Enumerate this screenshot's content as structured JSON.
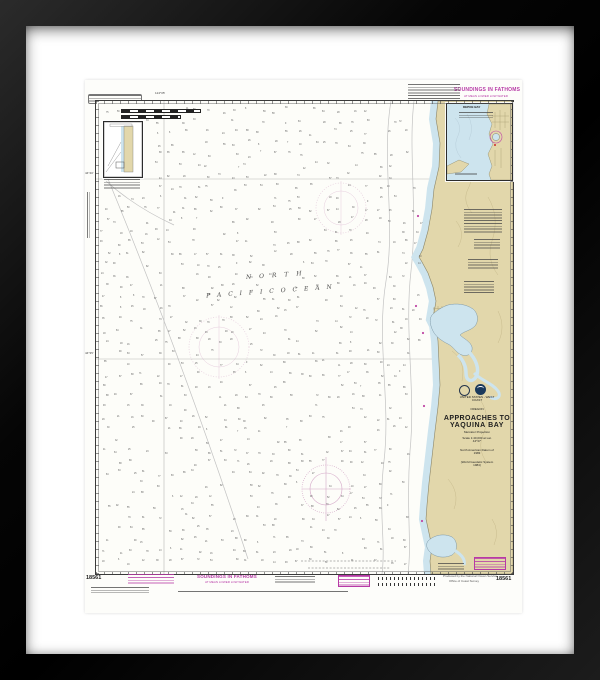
{
  "artwork": {
    "kind": "Framed NOAA nautical chart print",
    "chart_number": "18561"
  },
  "colors": {
    "frame": "#0a0a0a",
    "mat": "#ffffff",
    "paper": "#fdfdfa",
    "land_tan": "#e2d7ab",
    "shallow_water_blue": "#cde4ee",
    "chart_magenta": "#b73aa6",
    "sounding_gray": "#5f5f5f"
  },
  "chart": {
    "number": "18561",
    "soundings_heading": "SOUNDINGS IN FATHOMS",
    "soundings_subheading": "AT MEAN LOWER LOW WATER",
    "ocean_name_line1": "N O R T H",
    "ocean_name_line2": "P A C I F I C     O C E A N",
    "title_block": {
      "country": "UNITED STATES - WEST COAST",
      "state": "OREGON",
      "title1": "APPROACHES TO",
      "title2": "YAQUINA BAY",
      "proj1": "Mercator Projection",
      "proj2": "Scale 1:40,000 at Lat. 44°37'",
      "proj3": "North American Datum of 1983",
      "proj4": "(World Geodetic System 1984)"
    },
    "insets": {
      "top_right_title": "DEPOE BAY"
    },
    "graduation": {
      "top_label": "124°05'",
      "left_label_upper": "44°40'",
      "left_label_lower": "44°35'"
    },
    "bottom_margin": {
      "number_left": "18561",
      "number_right": "18561",
      "produced_by1": "Produced by the National Ocean Service",
      "produced_by2": "Office of Coast Survey"
    },
    "soundings_field": {
      "seed": 181561,
      "row_step": 11,
      "col_step": 13,
      "min_depth": 6,
      "max_depth": 95
    }
  }
}
